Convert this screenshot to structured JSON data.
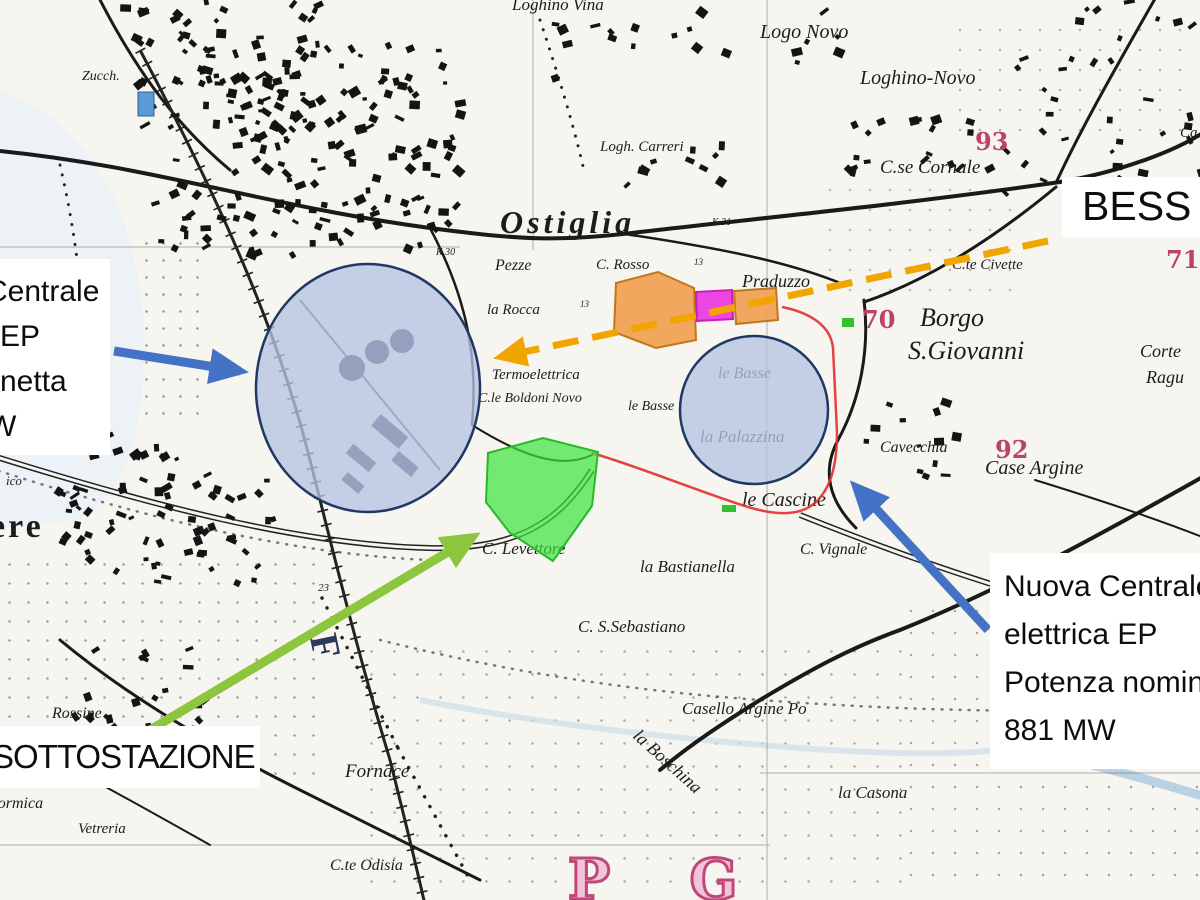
{
  "annotations": {
    "bess": {
      "text": "BESS"
    },
    "existing_plant": {
      "lines": [
        "Centrale",
        "EP",
        "netta",
        "W"
      ]
    },
    "substation": {
      "text": "SOTTOSTAZIONE"
    },
    "new_plant": {
      "lines": [
        "Nuova Centrale",
        "elettrica EP",
        "Potenza nominale",
        "881 MW"
      ]
    }
  },
  "colors": {
    "annotation_arrow_blue": "#4472C4",
    "annotation_arrow_green": "#8CC63F",
    "annotation_arrow_yellow_dashed": "#F0A500",
    "overlay_circle_fill": "#B6C4E1",
    "overlay_circle_border": "#1F3864",
    "site_area_orange": "#F0A050",
    "site_area_magenta": "#EC3CE0",
    "site_area_green": "#3CE43C",
    "boundary_red": "#E03030",
    "map_grid_number_red": "#BB4466"
  },
  "map_labels": [
    {
      "t": "Loghino Vina",
      "x": 512,
      "y": -4,
      "s": 17,
      "c": "it"
    },
    {
      "t": "Logo Novo",
      "x": 760,
      "y": 22,
      "s": 20,
      "c": "it"
    },
    {
      "t": "Loghino-Novo",
      "x": 860,
      "y": 68,
      "s": 20,
      "c": "it"
    },
    {
      "t": "93",
      "x": 975,
      "y": 130,
      "s": 24,
      "c": "red"
    },
    {
      "t": "C.se Cornale",
      "x": 880,
      "y": 158,
      "s": 19,
      "c": "it"
    },
    {
      "t": "Logh. Carreri",
      "x": 600,
      "y": 140,
      "s": 15,
      "c": "it"
    },
    {
      "t": "Ostiglia",
      "x": 500,
      "y": 206,
      "s": 32,
      "c": "town"
    },
    {
      "t": "Pezze",
      "x": 495,
      "y": 258,
      "s": 16,
      "c": "it"
    },
    {
      "t": "C. Rosso",
      "x": 596,
      "y": 258,
      "s": 15,
      "c": "it"
    },
    {
      "t": "la Rocca",
      "x": 487,
      "y": 303,
      "s": 15,
      "c": "it"
    },
    {
      "t": "Praduzzo",
      "x": 742,
      "y": 272,
      "s": 18,
      "c": "it"
    },
    {
      "t": "C.te Civette",
      "x": 952,
      "y": 258,
      "s": 15,
      "c": "it"
    },
    {
      "t": "71",
      "x": 1166,
      "y": 248,
      "s": 24,
      "c": "red"
    },
    {
      "t": "70",
      "x": 862,
      "y": 308,
      "s": 24,
      "c": "red"
    },
    {
      "t": "Borgo",
      "x": 920,
      "y": 305,
      "s": 26,
      "c": "it"
    },
    {
      "t": "S.Giovanni",
      "x": 908,
      "y": 338,
      "s": 26,
      "c": "it"
    },
    {
      "t": "Corte",
      "x": 1140,
      "y": 342,
      "s": 18,
      "c": "it"
    },
    {
      "t": "Ragu",
      "x": 1146,
      "y": 368,
      "s": 18,
      "c": "it"
    },
    {
      "t": "Termoelettrica",
      "x": 492,
      "y": 368,
      "s": 15,
      "c": "it"
    },
    {
      "t": "C.le Boldoni Novo",
      "x": 478,
      "y": 392,
      "s": 14,
      "c": "it"
    },
    {
      "t": "le Basse",
      "x": 628,
      "y": 400,
      "s": 14,
      "c": "it"
    },
    {
      "t": "le Basse",
      "x": 718,
      "y": 366,
      "s": 16,
      "c": "it"
    },
    {
      "t": "la Palazzina",
      "x": 700,
      "y": 428,
      "s": 17,
      "c": "it"
    },
    {
      "t": "Cavecchia",
      "x": 880,
      "y": 440,
      "s": 16,
      "c": "it"
    },
    {
      "t": "92",
      "x": 995,
      "y": 438,
      "s": 24,
      "c": "red"
    },
    {
      "t": "Case Argine",
      "x": 985,
      "y": 458,
      "s": 20,
      "c": "it"
    },
    {
      "t": "le Cascine",
      "x": 742,
      "y": 490,
      "s": 20,
      "c": "it"
    },
    {
      "t": "C. Levettore",
      "x": 482,
      "y": 540,
      "s": 17,
      "c": "it"
    },
    {
      "t": "la Bastianella",
      "x": 640,
      "y": 558,
      "s": 17,
      "c": "it"
    },
    {
      "t": "C. Vignale",
      "x": 800,
      "y": 542,
      "s": 16,
      "c": "it"
    },
    {
      "t": "C. S.Sebastiano",
      "x": 578,
      "y": 618,
      "s": 17,
      "c": "it"
    },
    {
      "t": "Casello Argine Po",
      "x": 682,
      "y": 700,
      "s": 17,
      "c": "it"
    },
    {
      "t": "la Casona",
      "x": 838,
      "y": 784,
      "s": 17,
      "c": "it"
    },
    {
      "t": "la Boschina",
      "x": 642,
      "y": 726,
      "s": 18,
      "c": "it",
      "r": 42
    },
    {
      "t": "Fornace",
      "x": 345,
      "y": 762,
      "s": 19,
      "c": "it"
    },
    {
      "t": "C.te Odisia",
      "x": 330,
      "y": 858,
      "s": 16,
      "c": "it"
    },
    {
      "t": "Vetreria",
      "x": 78,
      "y": 822,
      "s": 15,
      "c": "it"
    },
    {
      "t": "Formica",
      "x": -12,
      "y": 796,
      "s": 16,
      "c": "it"
    },
    {
      "t": "Rossine",
      "x": 52,
      "y": 706,
      "s": 16,
      "c": "it"
    },
    {
      "t": "ere",
      "x": -10,
      "y": 510,
      "s": 34,
      "c": "bigtown"
    },
    {
      "t": "ico",
      "x": 6,
      "y": 474,
      "s": 13,
      "c": "it"
    },
    {
      "t": "68",
      "x": -6,
      "y": 315,
      "s": 22,
      "c": "red"
    },
    {
      "t": "Zucch.",
      "x": 82,
      "y": 70,
      "s": 14,
      "c": "it"
    },
    {
      "t": "F",
      "x": 342,
      "y": 630,
      "s": 40,
      "c": "fr",
      "r": 78
    },
    {
      "t": "P G",
      "x": 568,
      "y": 852,
      "s": 56,
      "c": "pg"
    },
    {
      "t": "23",
      "x": 318,
      "y": 583,
      "s": 11,
      "c": "it"
    },
    {
      "t": "K.31",
      "x": 712,
      "y": 218,
      "s": 10,
      "c": "it"
    },
    {
      "t": "K.30",
      "x": 436,
      "y": 248,
      "s": 10,
      "c": "it"
    },
    {
      "t": "13",
      "x": 694,
      "y": 258,
      "s": 9,
      "c": "it"
    },
    {
      "t": "13",
      "x": 580,
      "y": 300,
      "s": 9,
      "c": "it"
    },
    {
      "t": "Ca",
      "x": 1180,
      "y": 126,
      "s": 15,
      "c": "it"
    }
  ],
  "building_clusters": [
    {
      "x": 118,
      "y": -5,
      "w": 200,
      "h": 150,
      "n": 80
    },
    {
      "x": 230,
      "y": 40,
      "w": 230,
      "h": 120,
      "n": 70
    },
    {
      "x": 150,
      "y": 150,
      "w": 180,
      "h": 110,
      "n": 45
    },
    {
      "x": 330,
      "y": 150,
      "w": 130,
      "h": 100,
      "n": 30
    },
    {
      "x": 55,
      "y": 430,
      "w": 120,
      "h": 140,
      "n": 45
    },
    {
      "x": 150,
      "y": 470,
      "w": 120,
      "h": 110,
      "n": 35
    },
    {
      "x": 620,
      "y": 140,
      "w": 110,
      "h": 55,
      "n": 10
    },
    {
      "x": 840,
      "y": 115,
      "w": 190,
      "h": 75,
      "n": 22
    },
    {
      "x": 1040,
      "y": 85,
      "w": 160,
      "h": 115,
      "n": 22
    },
    {
      "x": 990,
      "y": 0,
      "w": 200,
      "h": 70,
      "n": 14
    },
    {
      "x": 60,
      "y": 640,
      "w": 150,
      "h": 120,
      "n": 26
    },
    {
      "x": 845,
      "y": 380,
      "w": 110,
      "h": 95,
      "n": 13
    },
    {
      "x": 540,
      "y": 0,
      "w": 160,
      "h": 80,
      "n": 12
    },
    {
      "x": 700,
      "y": 0,
      "w": 140,
      "h": 60,
      "n": 8
    }
  ]
}
